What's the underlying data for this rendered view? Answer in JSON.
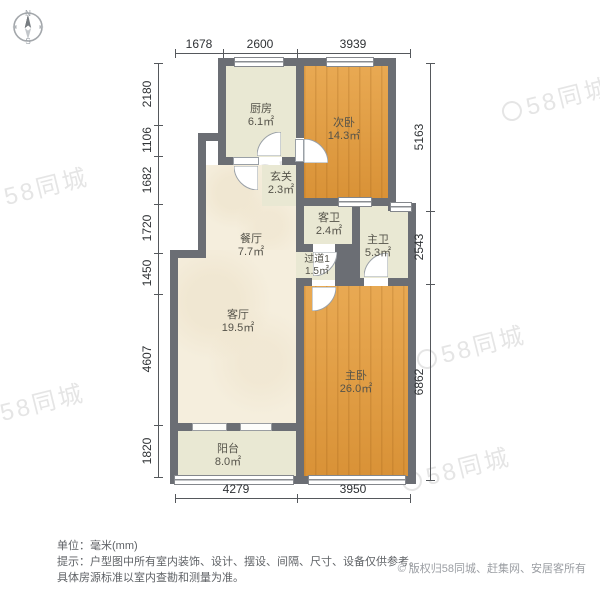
{
  "compass": {
    "north": "N",
    "south": "S"
  },
  "dims": {
    "top": [
      "1678",
      "2600",
      "3939"
    ],
    "left": [
      "2180",
      "1106",
      "1682",
      "1720",
      "1450",
      "4607",
      "1820"
    ],
    "right": [
      "5163",
      "2543",
      "6862"
    ],
    "bottom": [
      "4279",
      "3950"
    ]
  },
  "rooms": {
    "kitchen": {
      "name": "厨房",
      "area": "6.1㎡"
    },
    "bedroom2": {
      "name": "次卧",
      "area": "14.3㎡"
    },
    "entry": {
      "name": "玄关",
      "area": "2.3㎡"
    },
    "dining": {
      "name": "餐厅",
      "area": "7.7㎡"
    },
    "guest_bath": {
      "name": "客卫",
      "area": "2.4㎡"
    },
    "master_bath": {
      "name": "主卫",
      "area": "5.3㎡"
    },
    "hallway": {
      "name": "过道1",
      "area": "1.5㎡"
    },
    "living": {
      "name": "客厅",
      "area": "19.5㎡"
    },
    "master_bedroom": {
      "name": "主卧",
      "area": "26.0㎡"
    },
    "balcony": {
      "name": "阳台",
      "area": "8.0㎡"
    }
  },
  "footer": {
    "unit_line": "单位：毫米(mm)",
    "tip_line1": "提示：户型图中所有室内装饰、设计、摆设、间隔、尺寸、设备仅供参考。",
    "tip_line2": "具体房源标准以室内查勘和测量为准。",
    "copyright_symbol": "©",
    "copyright": "版权归58同城、赶集网、安居客所有"
  },
  "watermark": {
    "text": "58同城"
  },
  "colors": {
    "wall": "#6b6e74",
    "floor_warm": "#f5eedd",
    "floor_cool": "#e9e8d3",
    "floor_wood": "#e19a3c"
  }
}
